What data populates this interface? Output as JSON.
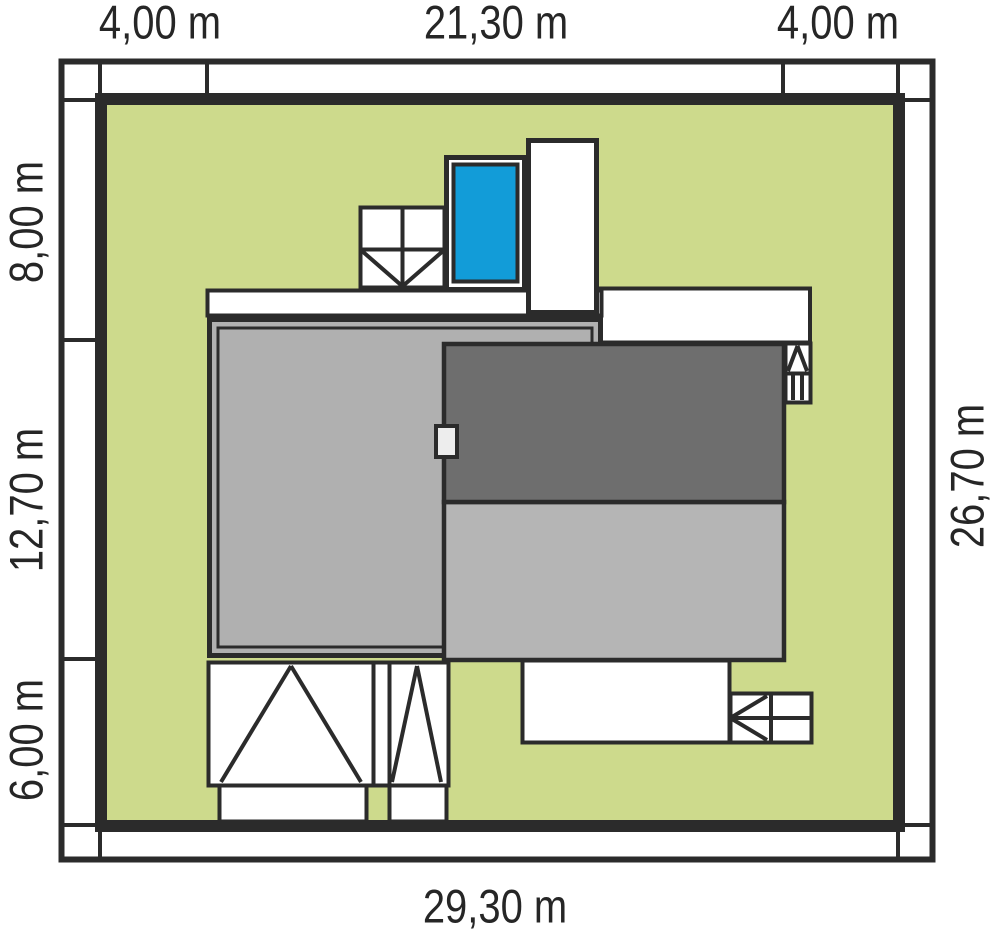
{
  "diagram": {
    "kind": "house-plot-site-plan",
    "dimensions": {
      "top": [
        "4,00 m",
        "21,30 m",
        "4,00 m"
      ],
      "left": [
        "8,00 m",
        "12,70 m",
        "6,00 m"
      ],
      "right": [
        "26,70 m"
      ],
      "bottom": [
        "29,30 m"
      ]
    },
    "colors": {
      "plot_green": "#cdda8c",
      "pool_blue": "#129cd8",
      "roof_dark": "#6e6e6e",
      "roof_light": "#b5b5b5",
      "garage_gray": "#b0b0b0",
      "chimney_white": "#ededed",
      "line_dark": "#2b2b2b"
    }
  }
}
